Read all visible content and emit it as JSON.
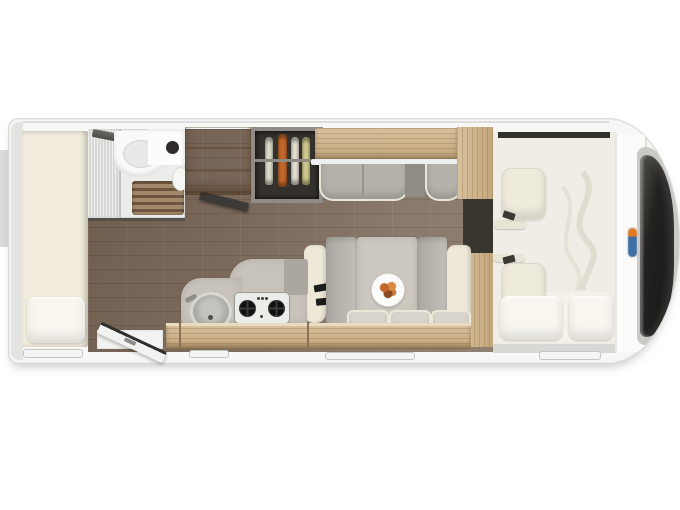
{
  "scene": {
    "type": "motorhome-floorplan-top-view",
    "background_color": "#ffffff",
    "orientation": {
      "front": "right",
      "rear": "left"
    }
  },
  "vehicle": {
    "body_fill": "#f7f7f6",
    "body_outline": "#d9dad9",
    "skirt_color": "#d7d7d4",
    "windshield_glass": "#1c1b19",
    "windshield_chrome": "#c9c9c6",
    "service_flap_count": 4,
    "entry_door": {
      "state": "open",
      "edge_color": "#2f2f2d",
      "face_color": "#f2f2f0"
    }
  },
  "brand_badge": {
    "primary_color": "#3f6fa5",
    "accent_color": "#e07a26"
  },
  "interior": {
    "floor": {
      "wood_dark": "#6e5c4d",
      "wood_light": "#8f8072"
    },
    "rear_bed": {
      "mattress_color": "#f1ecdd",
      "pillow_color": "#f8f6ef",
      "pillow_count": 1
    },
    "bathroom": {
      "wall_color": "#ececea",
      "shower_panel_color": "#d8d8d6",
      "shower_grate_color": "#a2896c",
      "grate_slat_color": "#6e5540",
      "basin_color": "#f9f9f8",
      "toilet_color": "#f6f6f4"
    },
    "tv_color": "#3b3a37",
    "wardrobe_wood": "#cdb38c",
    "bottle_rack": {
      "frame_color": "#908b85",
      "interior_color": "#34312c",
      "bottle_count": 4,
      "bottle_colors": [
        "#ded9cb",
        "#c2672a",
        "#e3ded0",
        "#cdc98d"
      ]
    },
    "travel_bench": {
      "upholstery_color": "#b3b1aa",
      "trim_color": "#eae6d7",
      "seat_count": 2
    },
    "dinette": {
      "table_color": "#ccc8c0",
      "backrest_color": "#b5b3ac",
      "bolster_color": "#ede8d8",
      "cushion_count": 3,
      "seatbelt_color": "#1c1c1a",
      "plate_color": "#fbfbfa",
      "food_color": "#c2672a"
    },
    "kitchen": {
      "counter_color": "#c7c3ba",
      "hob_color": "#ecece9",
      "burner_count": 2,
      "knob_count": 4,
      "sink_color": "#aeada8",
      "base_drawer_wood": "#c9ad82"
    },
    "cab": {
      "panel_color": "#efede5",
      "seat_color": "#eeeadc",
      "seat_count": 2,
      "dropdown_bed_pillow_count": 2,
      "pillow_color": "#f8f6ef",
      "top_trim_color": "#32302c"
    }
  }
}
